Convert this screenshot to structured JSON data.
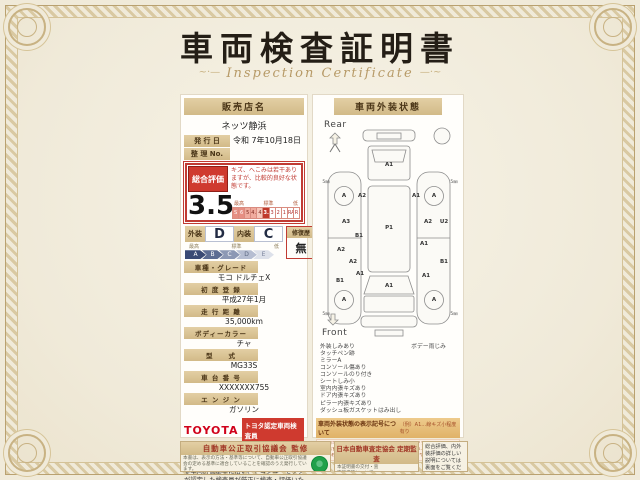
{
  "page": {
    "title": "車両検査証明書",
    "subtitle": "Inspection Certificate"
  },
  "left_panel": {
    "dealer_label": "販売店名",
    "dealer_name": "ネッツ静浜",
    "issue_date_label": "発 行 日",
    "issue_date": "令和 7年10月18日",
    "ref_no_label": "整 理 No.",
    "ref_no": "",
    "overall": {
      "label": "総合評価",
      "comment": "キズ、へこみは若干ありますが、比較的良好な状態です。",
      "score": "3.5",
      "scale_high": "最高",
      "scale_mid": "標準",
      "scale_low": "低",
      "scale": [
        "S",
        "6",
        "5",
        "4.5",
        "4",
        "3.5",
        "3",
        "2",
        "1",
        "RA",
        "R"
      ]
    },
    "grades": {
      "exterior_label": "外装",
      "exterior": "D",
      "interior_label": "内装",
      "interior": "C",
      "repair_label": "修復歴",
      "repair": "無",
      "scale": [
        "A",
        "B",
        "C",
        "D",
        "E"
      ],
      "scale_high": "最高",
      "scale_mid": "標準",
      "scale_low": "低"
    },
    "fields": [
      {
        "label": "車種・グレード",
        "value": "モコ ドルチェX"
      },
      {
        "label": "初 度 登 録",
        "value": "平成27年1月"
      },
      {
        "label": "走 行 距 離",
        "value": "35,000km"
      },
      {
        "label": "ボディーカラー",
        "value": "チャ"
      },
      {
        "label": "型　　式",
        "value": "MG33S"
      },
      {
        "label": "車 台 番 号",
        "value": "XXXXXXX755"
      },
      {
        "label": "エ ン ジ ン",
        "value": "ガソリン"
      }
    ],
    "toyota_logo": "TOYOTA",
    "toyota_badge": "トヨタ認定車両検査員",
    "inspector_id": "XXXXXX",
    "note": "当車両は、自動車オークションで運用される車両評価基準に沿い、トヨタユーゼックが認定した検査員が厳正に検査・評価いたしました。"
  },
  "right_panel": {
    "header": "車両外装状態",
    "rear_label": "Rear",
    "front_label": "Front",
    "diagram": {
      "markers": [
        {
          "t": "A1"
        },
        {
          "t": "A"
        },
        {
          "t": "A2"
        },
        {
          "t": "A1"
        },
        {
          "t": "A"
        },
        {
          "t": "A3"
        },
        {
          "t": "B1"
        },
        {
          "t": "A2"
        },
        {
          "t": "U2"
        },
        {
          "t": "P1"
        },
        {
          "t": "A2"
        },
        {
          "t": "A2"
        },
        {
          "t": "A1"
        },
        {
          "t": "B1"
        },
        {
          "t": "A1"
        },
        {
          "t": "B1"
        },
        {
          "t": "A1"
        },
        {
          "t": "A1"
        },
        {
          "t": "A"
        },
        {
          "t": "A"
        },
        {
          "t": "5㎜"
        },
        {
          "t": "5㎜"
        },
        {
          "t": "5㎜"
        },
        {
          "t": "5㎜"
        }
      ]
    },
    "defects_col1": [
      "外装しみあり",
      "タッチペン跡",
      "ミラーA",
      "コンソール傷あり",
      "コンソールのり付き",
      "シートしみ小",
      "室内内張キズあり",
      "ドア内張キズあり",
      "ピラー内張キズあり",
      "ダッシュ板ガスケットはみ出し"
    ],
    "defects_col2": [
      "ボデー雨じみ"
    ],
    "legend_title": "車両外装状態の表示記号について",
    "legend_example": "（例）A1…線キズ小程度有り",
    "legend_lines": [
      "A…線キズあり　U…ヘコミあり　B…キズを伴うヘコミあり　P…塗装あれ　W…補修跡あり　S…サビあり",
      "C…腐食あり　G…フロントガラスキズあり　X…要交換（亀裂・割れ等）あり　XX…交換済あり",
      "1…小程度　2…中程度　3…中程度以上。タイヤ横の数字は、残り溝を表示しています。"
    ]
  },
  "footer": {
    "left_box": {
      "title": "自動車公正取引協議会 監修",
      "body": "本書は、表示の方法・基準等について、自動車公正取引協議会の定める基準に適合していることを確認のうえ発行しています。"
    },
    "middle_box": {
      "title": "日本自動車査定協会 定期監査",
      "body": "本証明書の交付・査定基準等について、日本自動車査定協会による監査を定期的に実施しています。",
      "logo": "JAAI"
    },
    "right_box": {
      "text": "総合評価、内外装評価の詳しい説明については裏面をご覧ください。"
    }
  }
}
